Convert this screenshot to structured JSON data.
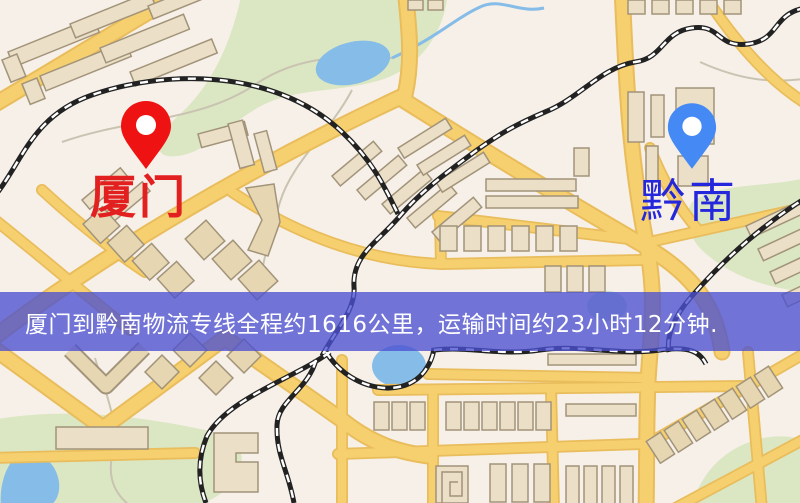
{
  "map": {
    "markers": [
      {
        "id": "origin",
        "label": "厦门",
        "pin_color": "#ee1212",
        "label_color": "#e32020"
      },
      {
        "id": "destination",
        "label": "黔南",
        "pin_color": "#4589f4",
        "label_color": "#2527dd"
      }
    ],
    "banner": {
      "text": "厦门到黔南物流专线全程约1616公里，运输时间约23小时12分钟.",
      "background": "rgba(76,81,209,0.78)",
      "text_color": "#ffffff"
    },
    "route": {
      "origin": "厦门",
      "destination": "黔南",
      "distance_km": 1616,
      "duration_hours": 23,
      "duration_minutes": 12
    },
    "colors": {
      "background": "#f7f0e8",
      "road": "#f6cf6e",
      "road_casing": "#e9bd5c",
      "park": "#dbe6c3",
      "teal_patch": "#b7d8c8",
      "water": "#85bce8",
      "building": "#ebdfc7",
      "building_shade": "#e6d7b2",
      "building_outline": "#a2947a",
      "railway": "#222222",
      "trail": "#c9c3b2"
    }
  }
}
